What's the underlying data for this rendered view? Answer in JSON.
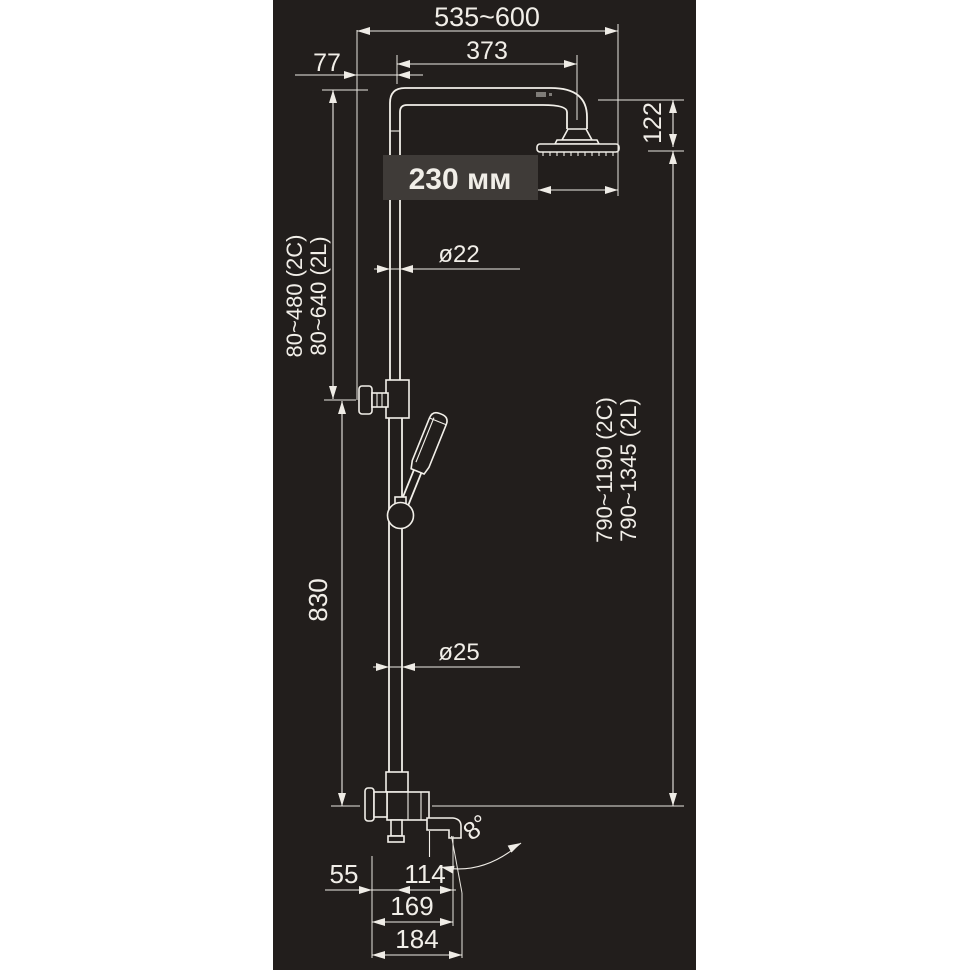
{
  "drawing": {
    "title": "shower-column-dimensional-drawing",
    "colors": {
      "background": "#ffffff",
      "panel": "#221e1c",
      "line": "#f2efe9",
      "callout_box": "#3f3b38",
      "text": "#f1eee8"
    },
    "dimensions": {
      "overall_width": "535~600",
      "arm_length": "373",
      "wall_offset_top": "77",
      "head_diameter_label": "230 мм",
      "head_drop": "122",
      "riser_upper_diameter": "ø22",
      "riser_lower_diameter": "ø25",
      "slider_range_2c": "80~480 (2C)",
      "slider_range_2l": "80~640 (2L)",
      "column_height_2c": "790~1190 (2C)",
      "column_height_2l": "790~1345 (2L)",
      "lower_column_height": "830",
      "spout_wall_offset": "55",
      "spout_reach": "114",
      "spout_reach_total": "169",
      "spout_reach_overall": "184",
      "spout_angle": "8°"
    }
  }
}
